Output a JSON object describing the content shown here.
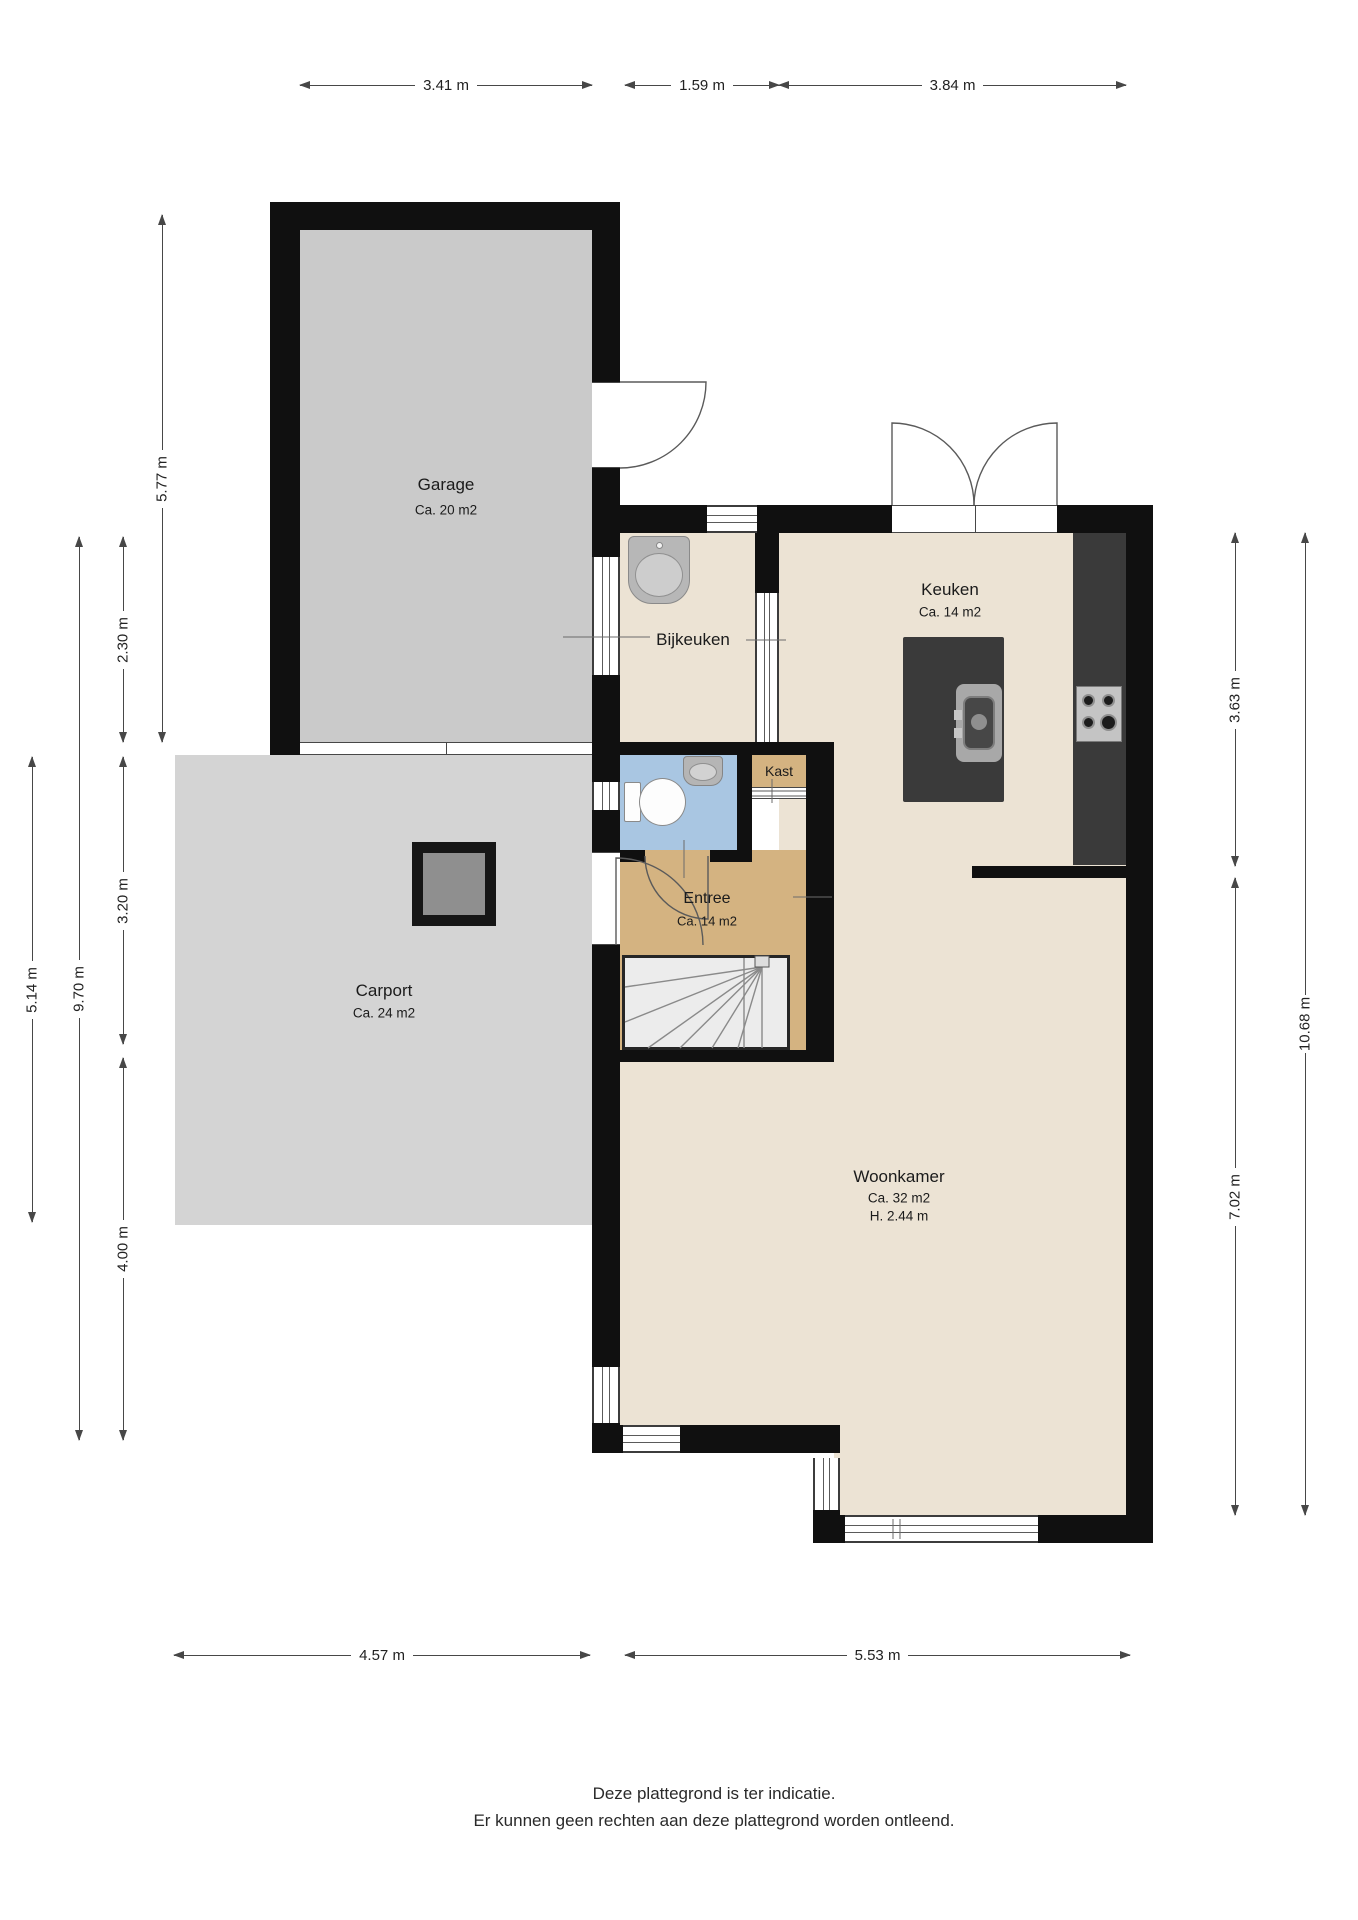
{
  "rooms": {
    "garage": {
      "name": "Garage",
      "area": "Ca. 20 m2"
    },
    "bijkeuken": {
      "name": "Bijkeuken"
    },
    "keuken": {
      "name": "Keuken",
      "area": "Ca. 14 m2"
    },
    "kast": {
      "name": "Kast"
    },
    "entree": {
      "name": "Entree",
      "area": "Ca. 14 m2"
    },
    "carport": {
      "name": "Carport",
      "area": "Ca. 24 m2"
    },
    "woonkamer": {
      "name": "Woonkamer",
      "area": "Ca. 32 m2",
      "height": "H. 2.44 m"
    }
  },
  "dimensions": {
    "top": [
      "3.41 m",
      "1.59 m",
      "3.84 m"
    ],
    "bottom": [
      "4.57 m",
      "5.53 m"
    ],
    "left": [
      "5.77 m",
      "2.30 m",
      "3.20 m",
      "4.00 m",
      "9.70 m",
      "5.14 m"
    ],
    "right": [
      "3.63 m",
      "7.02 m",
      "10.68 m"
    ]
  },
  "footer": {
    "line1": "Deze plattegrond is ter indicatie.",
    "line2": "Er kunnen geen rechten aan deze plattegrond worden ontleend."
  },
  "colors": {
    "wall": "#101010",
    "room_cream": "#ece3d4",
    "entree_tan": "#d4b381",
    "toilet_blue": "#a9c6e2",
    "garage_gray": "#cacaca",
    "carport_gray": "#d4d4d4",
    "counter_dark": "#3a3a3a"
  }
}
